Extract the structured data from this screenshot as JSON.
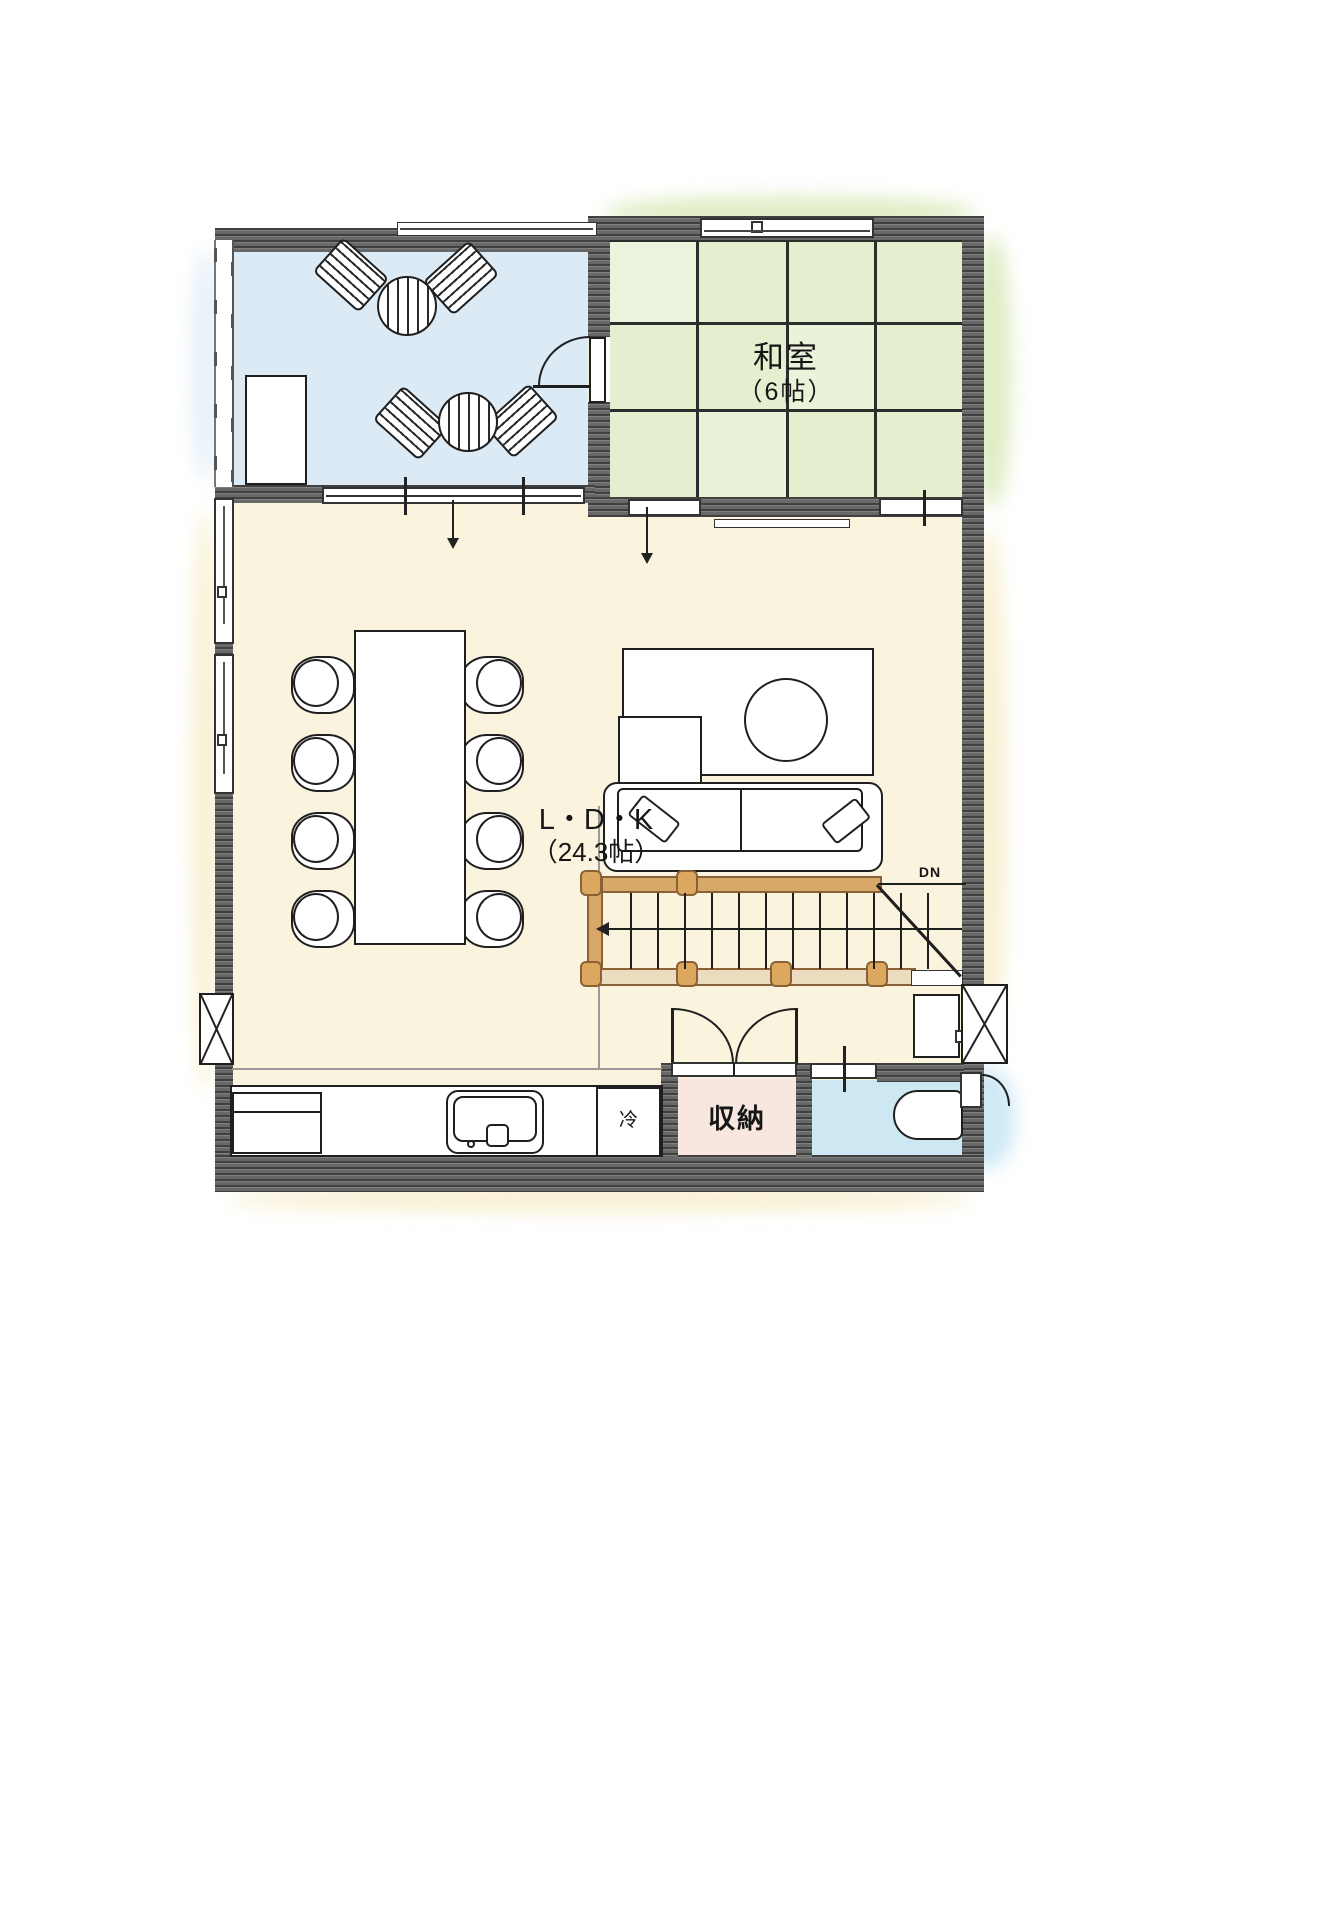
{
  "rooms": {
    "washitsu": {
      "label": "和室",
      "size": "（6帖）"
    },
    "ldk": {
      "label": "L・D・K",
      "size": "（24.3帖）"
    },
    "storage": {
      "label": "収納"
    },
    "refrigerator": {
      "label": "冷"
    },
    "stairs": {
      "label": "DN"
    }
  },
  "colors": {
    "terrace": "#dbeaf5",
    "tatami": "#e4efcf",
    "tatami_wash": "#d5e7b2",
    "ldk": "#faf3dd",
    "ldk_wash": "#f6ebc2",
    "storage": "#f8e7de",
    "bath": "#cde8f3",
    "bath_wash": "#bfe2f2",
    "wall_dark": "#686868",
    "railing": "#d8a868",
    "railing_light": "#ecdcbf",
    "outline": "#1f1f1f"
  }
}
